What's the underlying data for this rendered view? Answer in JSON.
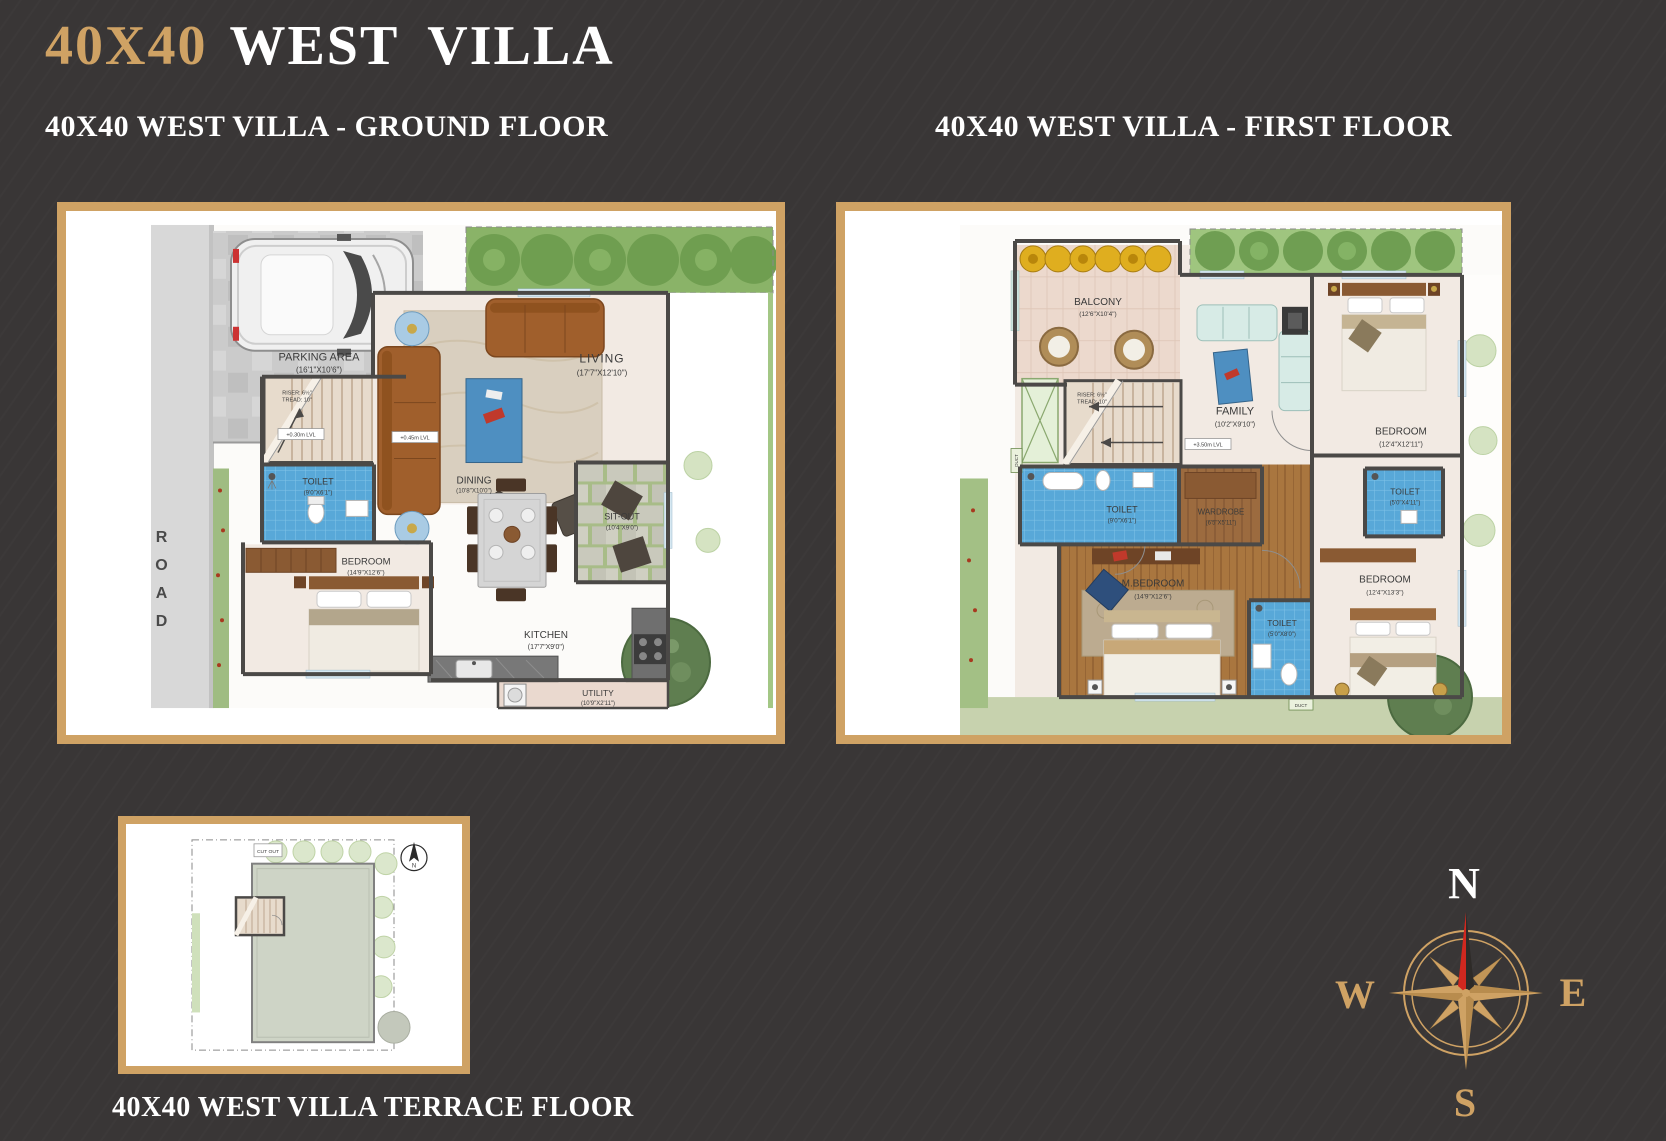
{
  "brand": {
    "size": "40X40",
    "name": "WEST VILLA"
  },
  "ground": {
    "header": "40X40 WEST VILLA - GROUND FLOOR",
    "road_label": "ROAD",
    "stairs": {
      "riser": "RISER: 6½\"",
      "tread": "TREAD: 10\""
    },
    "levels": {
      "l030": "+0.30m LVL",
      "l045": "+0.45m LVL"
    },
    "rooms": {
      "parking": {
        "name": "PARKING AREA",
        "dims": "(16'1\"X10'6\")"
      },
      "living": {
        "name": "LIVING",
        "dims": "(17'7\"X12'10\")"
      },
      "toilet": {
        "name": "TOILET",
        "dims": "(9'0\"X6'1\")"
      },
      "dining": {
        "name": "DINING",
        "dims": "(10'8\"X10'0\")"
      },
      "sitout": {
        "name": "SIT-OUT",
        "dims": "(10'4\"X9'0\")"
      },
      "bedroom": {
        "name": "BEDROOM",
        "dims": "(14'9\"X12'6\")"
      },
      "kitchen": {
        "name": "KITCHEN",
        "dims": "(17'7\"X9'0\")"
      },
      "utility": {
        "name": "UTILITY",
        "dims": "(10'9\"X2'11\")"
      }
    }
  },
  "first": {
    "header": "40X40 WEST VILLA - FIRST FLOOR",
    "stairs": {
      "riser": "RISER: 6½\"",
      "tread": "TREAD: 10\""
    },
    "level": "+3.50m LVL",
    "duct": "DUCT",
    "rooms": {
      "balcony": {
        "name": "BALCONY",
        "dims": "(12'6\"X10'4\")"
      },
      "family": {
        "name": "FAMILY",
        "dims": "(10'2\"X9'10\")"
      },
      "bedroom_top": {
        "name": "BEDROOM",
        "dims": "(12'4\"X12'11\")"
      },
      "toilet_left": {
        "name": "TOILET",
        "dims": "(9'0\"X6'1\")"
      },
      "wardrobe": {
        "name": "WARDROBE",
        "dims": "(6'5\"X5'11\")"
      },
      "mbedroom": {
        "name": "M.BEDROOM",
        "dims": "(14'9\"X12'6\")"
      },
      "toilet_mid": {
        "name": "TOILET",
        "dims": "(5'0\"X8'0\")"
      },
      "toilet_right": {
        "name": "TOILET",
        "dims": "(5'0\"X4'11\")"
      },
      "bedroom_bottom": {
        "name": "BEDROOM",
        "dims": "(12'4\"X13'3\")"
      }
    }
  },
  "terrace": {
    "caption": "40X40 WEST VILLA TERRACE FLOOR",
    "cutout": "CUT OUT"
  },
  "compass": {
    "n": "N",
    "e": "E",
    "s": "S",
    "w": "W"
  },
  "colors": {
    "gold": "#cfa264",
    "background": "#393636",
    "wall": "#4b4947",
    "tile_blue": "#58a8d8",
    "wood": "#a9763f",
    "accent_red": "#d0281f"
  }
}
